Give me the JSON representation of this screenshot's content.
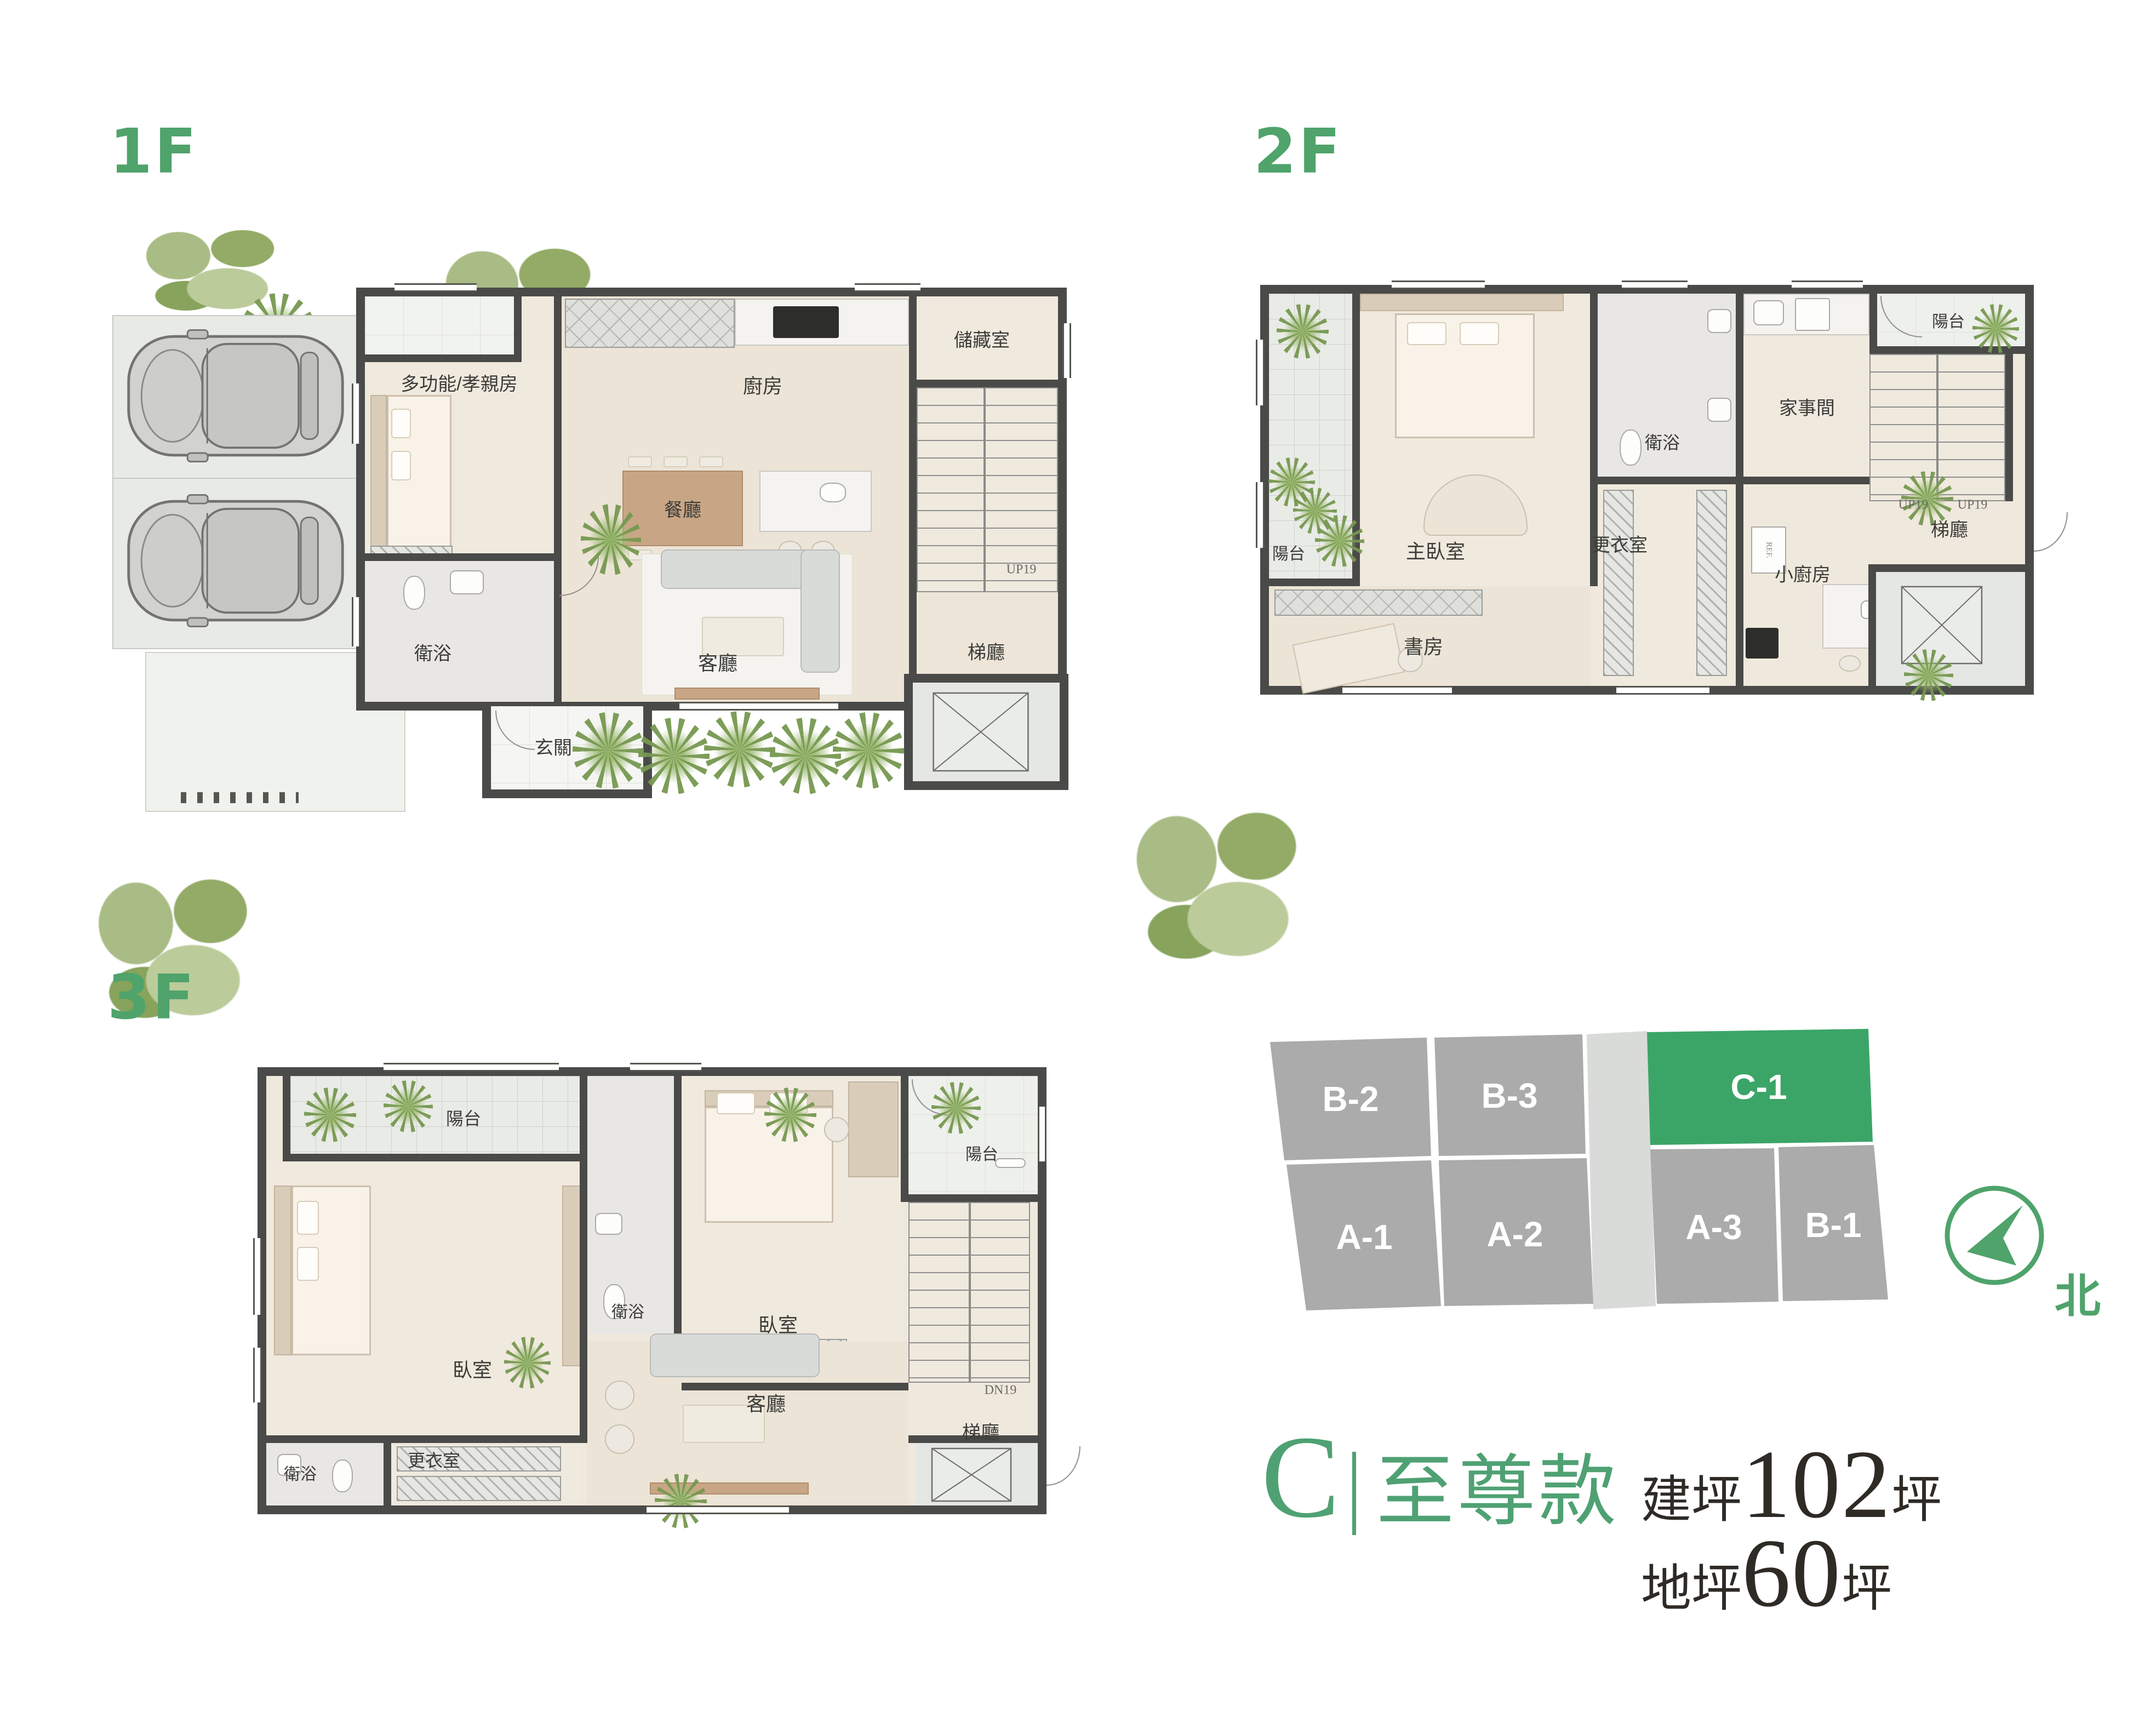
{
  "colors": {
    "accent_green": "#4FA36B",
    "title_green": "#4FA173",
    "site_unit_gray": "#ABABAB",
    "site_highlight_green": "#3BA567",
    "wall_dark": "#4A4A48",
    "label_dark": "#3C3C38",
    "title_text_dark": "#2E2A26"
  },
  "floors": {
    "f1": {
      "label": "1F",
      "rooms": {
        "multi": "多功能/孝親房",
        "kitchen": "廚房",
        "storage": "儲藏室",
        "dining": "餐廳",
        "bath": "衛浴",
        "living": "客廳",
        "entry": "玄關",
        "stair_hall": "梯廳"
      },
      "stairs_label": "UP19"
    },
    "f2": {
      "label": "2F",
      "rooms": {
        "balcony_left": "陽台",
        "master": "主臥室",
        "bath": "衛浴",
        "utility": "家事間",
        "balcony_right": "陽台",
        "kitchenette": "小廚房",
        "closet": "更衣室",
        "study": "書房",
        "stair_hall": "梯廳"
      },
      "stairs_label_1": "UP19",
      "stairs_label_2": "UP19",
      "fridge_label": "REF."
    },
    "f3": {
      "label": "3F",
      "rooms": {
        "balcony_top": "陽台",
        "bedroom_left": "臥室",
        "bath_top": "衛浴",
        "bedroom_right": "臥室",
        "balcony_right": "陽台",
        "living": "客廳",
        "closet": "更衣室",
        "bath_bottom": "衛浴",
        "stair_hall": "梯廳"
      },
      "stairs_label": "DN19"
    }
  },
  "site_plan": {
    "units": [
      {
        "id": "B-2",
        "highlighted": false
      },
      {
        "id": "B-3",
        "highlighted": false
      },
      {
        "id": "C-1",
        "highlighted": true
      },
      {
        "id": "A-1",
        "highlighted": false
      },
      {
        "id": "A-2",
        "highlighted": false
      },
      {
        "id": "A-3",
        "highlighted": false
      },
      {
        "id": "B-1",
        "highlighted": false
      }
    ],
    "north_label": "北"
  },
  "title": {
    "model_letter": "C",
    "divider": "|",
    "model_name": "至尊款",
    "building_area_label": "建坪",
    "building_area_value": "102",
    "building_area_unit": "坪",
    "land_area_label": "地坪",
    "land_area_value": "60",
    "land_area_unit": "坪"
  }
}
